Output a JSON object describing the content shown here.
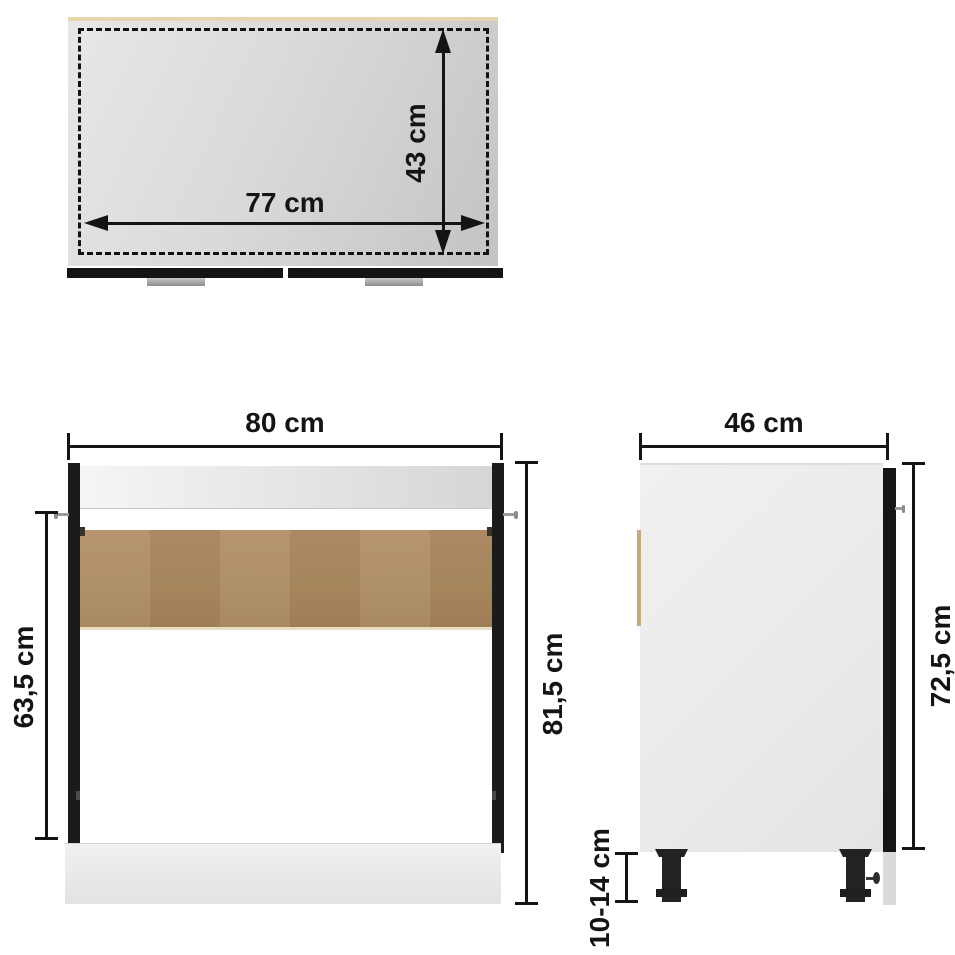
{
  "diagram": {
    "kind": "furniture-dimension-diagram",
    "subject": "sink base kitchen cabinet, three orthographic views",
    "colors": {
      "dimension_ink": "#141414",
      "wood_back_panel": "#ac8a60",
      "dark_panel": "#1b1b1b",
      "light_body": "#ececec",
      "top_edge_band": "#e6d5ae"
    },
    "views": {
      "top": {
        "name": "top view",
        "width_label": "77 cm",
        "depth_label": "43 cm"
      },
      "front": {
        "name": "front view",
        "width_label": "80 cm",
        "total_height_label": "81,5 cm",
        "side_panel_height_label": "63,5 cm"
      },
      "side": {
        "name": "side view",
        "depth_label": "46 cm",
        "body_height_label": "72,5 cm",
        "leg_height_label": "10-14 cm"
      }
    }
  }
}
